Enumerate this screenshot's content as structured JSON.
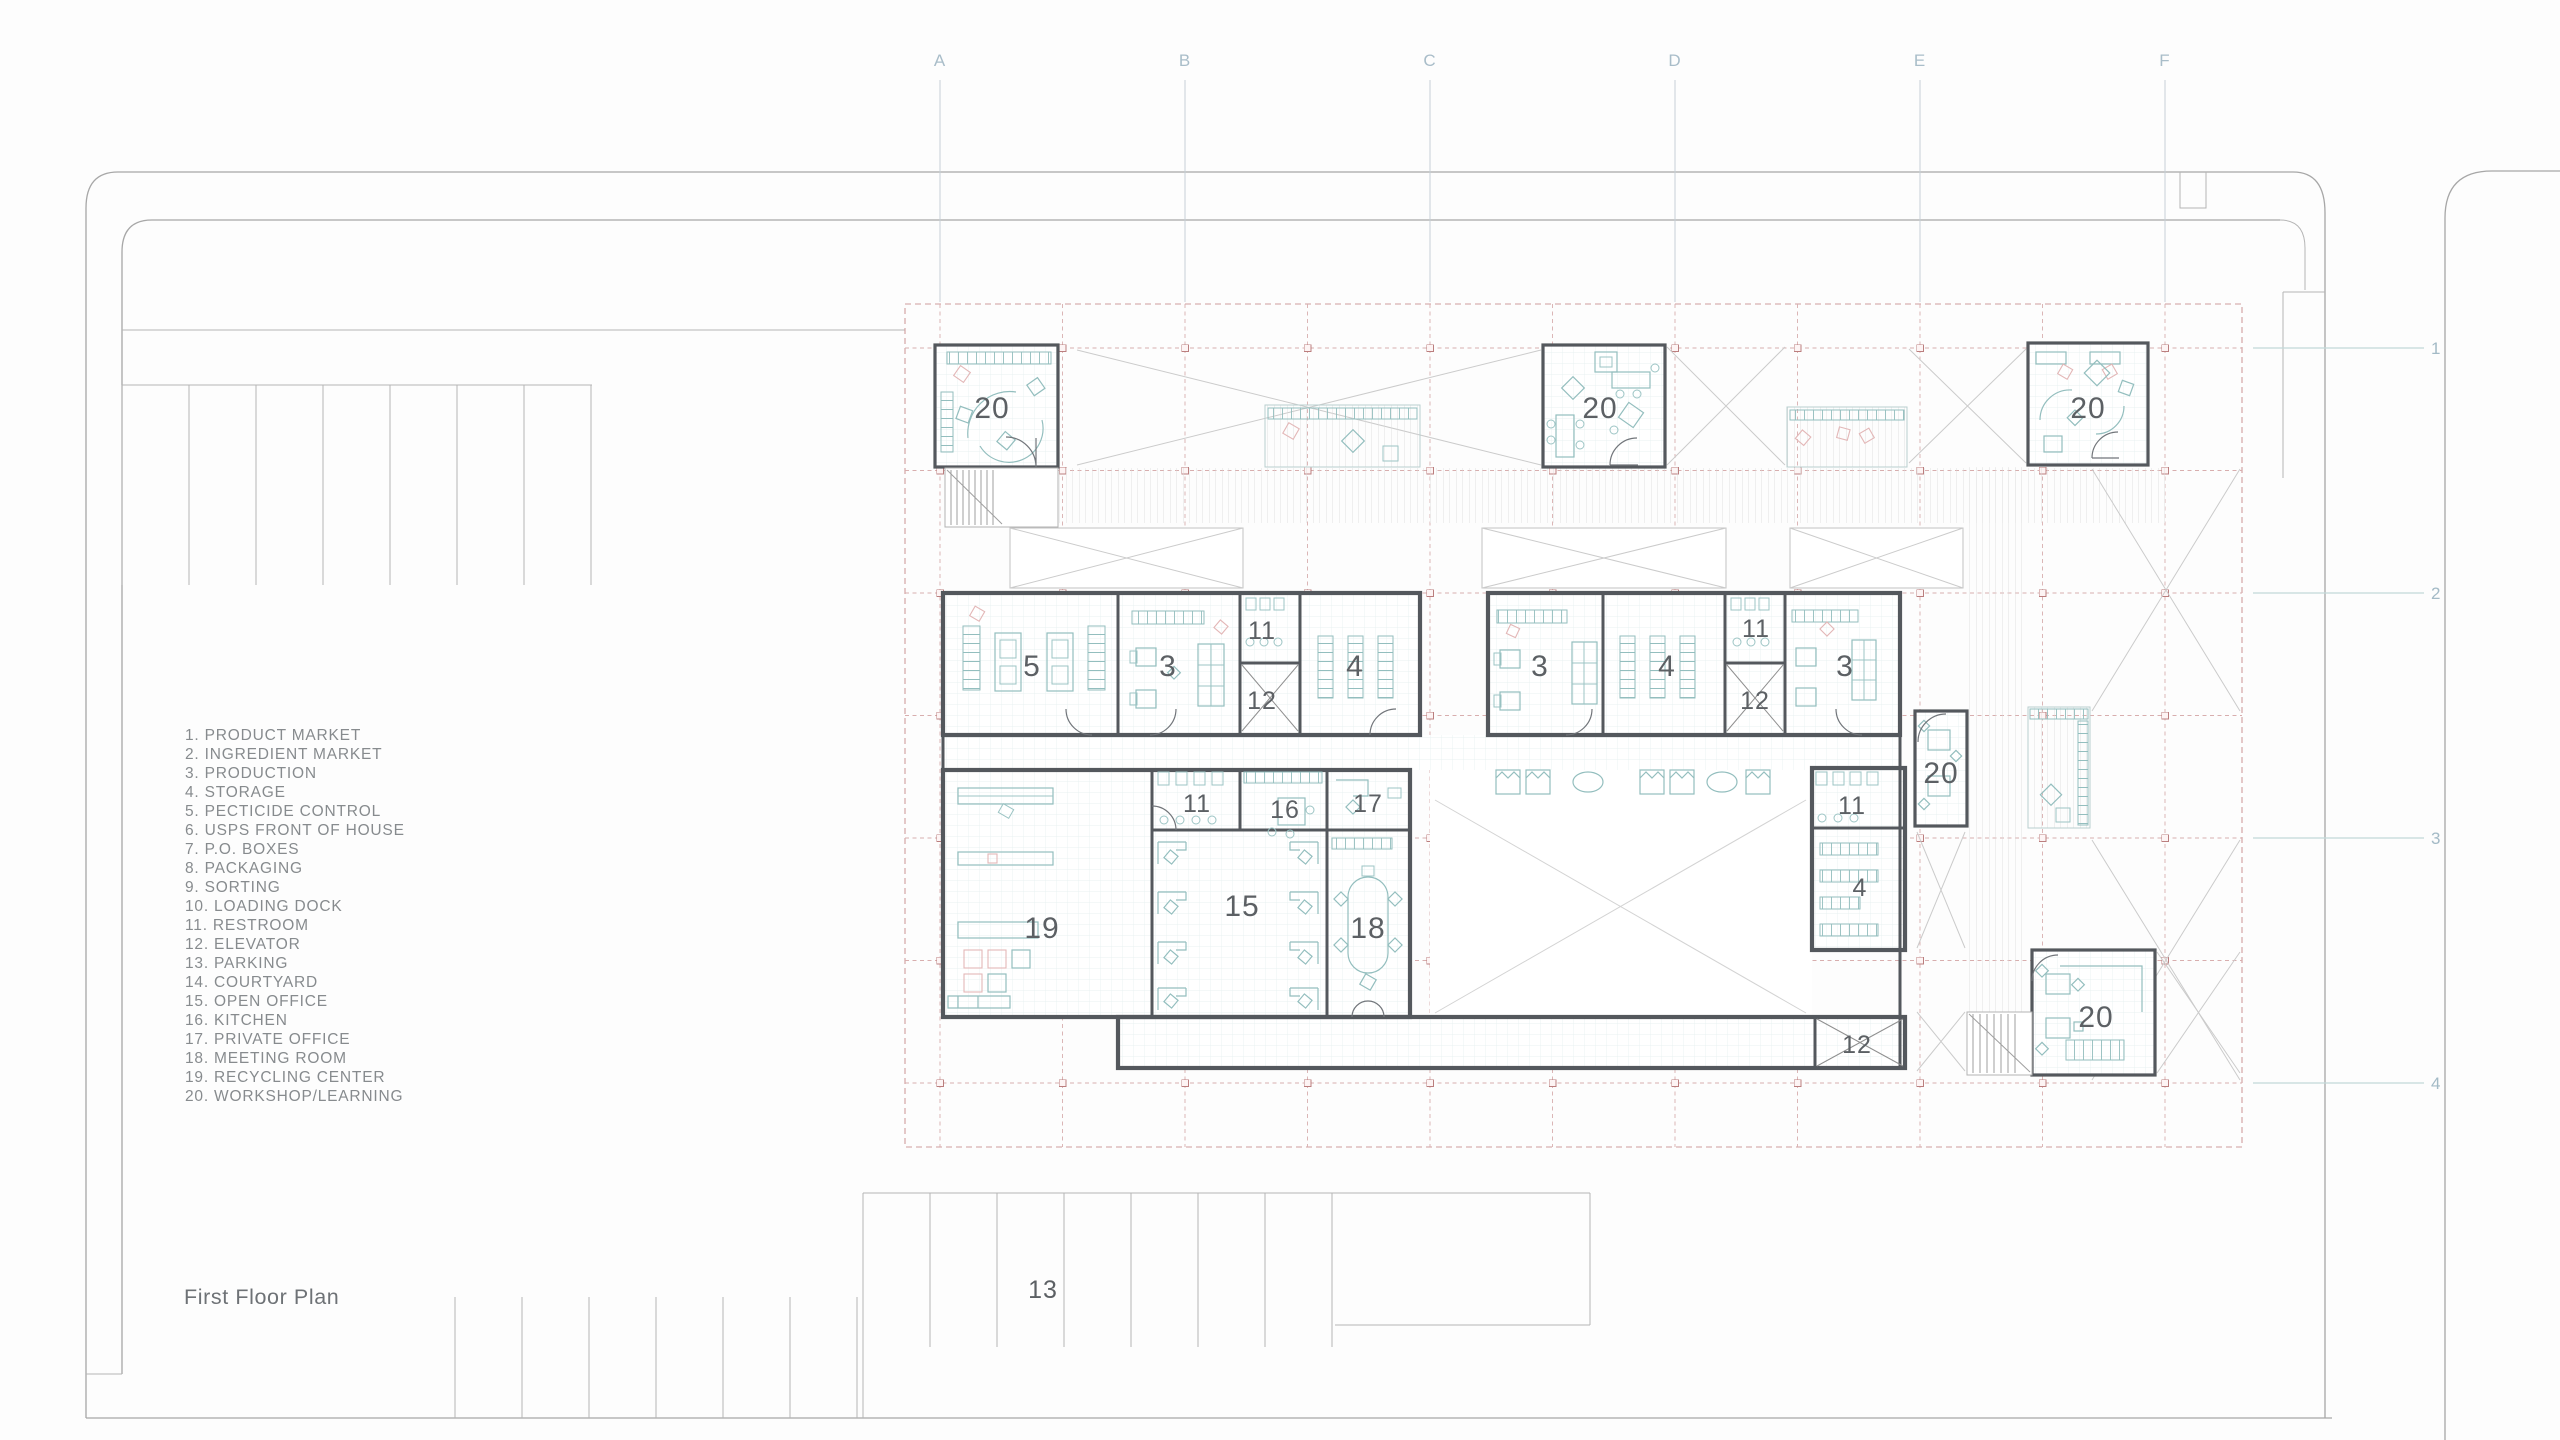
{
  "title": "First Floor Plan",
  "legend": {
    "items": [
      "1. PRODUCT MARKET",
      "2. INGREDIENT MARKET",
      "3. PRODUCTION",
      "4. STORAGE",
      "5. PECTICIDE CONTROL",
      "6. USPS FRONT OF HOUSE",
      "7. P.O. BOXES",
      "8. PACKAGING",
      "9. SORTING",
      "10. LOADING DOCK",
      "11. RESTROOM",
      "12. ELEVATOR",
      "13. PARKING",
      "14. COURTYARD",
      "15. OPEN OFFICE",
      "16. KITCHEN",
      "17. PRIVATE OFFICE",
      "18. MEETING ROOM",
      "19. RECYCLING CENTER",
      "20. WORKSHOP/LEARNING"
    ]
  },
  "grid": {
    "columns": [
      "A",
      "B",
      "C",
      "D",
      "E",
      "F"
    ],
    "rows": [
      "1",
      "2",
      "3",
      "4"
    ]
  },
  "plan": {
    "rooms": [
      {
        "n": "20"
      },
      {
        "n": "20"
      },
      {
        "n": "20"
      },
      {
        "n": "20"
      },
      {
        "n": "20"
      },
      {
        "n": "5"
      },
      {
        "n": "3"
      },
      {
        "n": "11"
      },
      {
        "n": "12"
      },
      {
        "n": "4"
      },
      {
        "n": "3"
      },
      {
        "n": "4"
      },
      {
        "n": "11"
      },
      {
        "n": "12"
      },
      {
        "n": "3"
      },
      {
        "n": "19"
      },
      {
        "n": "11"
      },
      {
        "n": "16"
      },
      {
        "n": "17"
      },
      {
        "n": "15"
      },
      {
        "n": "18"
      },
      {
        "n": "11"
      },
      {
        "n": "4"
      },
      {
        "n": "12"
      },
      {
        "n": "13"
      }
    ]
  },
  "colors": {
    "grid_dash_pink": "#cf9d9d",
    "furniture_teal": "#93bebe",
    "furniture_pink": "#e3b7b7",
    "wall_gray": "#54585d",
    "grid_label_blue": "#a9bdc9",
    "site_line_gray": "#a7a7a7"
  }
}
